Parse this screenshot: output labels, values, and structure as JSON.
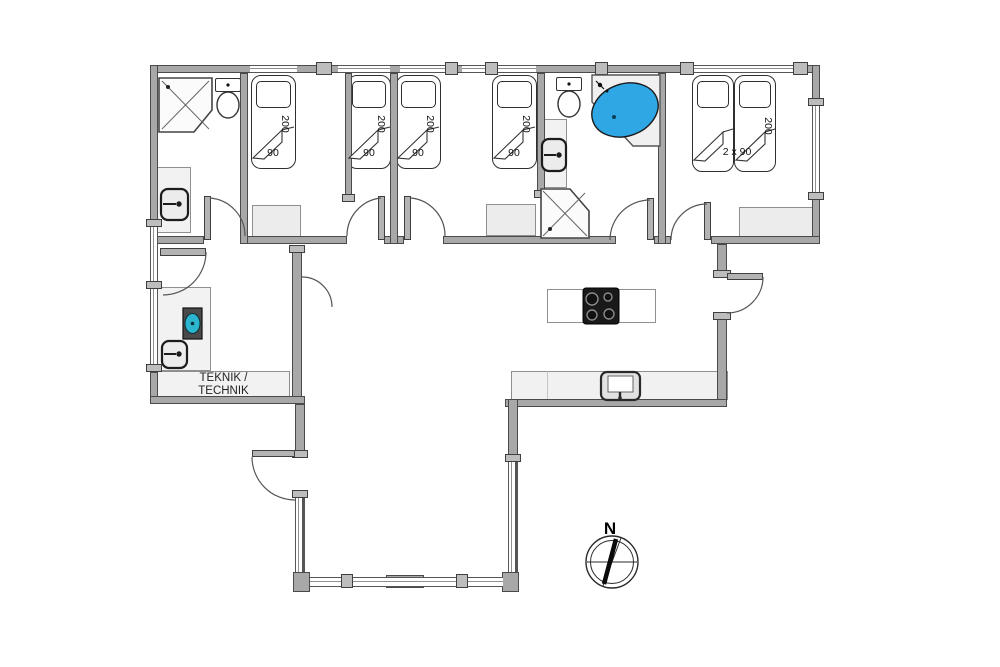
{
  "floorplan": {
    "bedrooms": {
      "bed1": {
        "length": "200",
        "width": "90"
      },
      "bed2": {
        "length": "200",
        "width": "90"
      },
      "bed3": {
        "length": "200",
        "width": "90"
      },
      "bed4": {
        "length": "200",
        "width": "90"
      },
      "double_bed": {
        "length": "200",
        "width": "2 x 90"
      }
    },
    "technical_room": {
      "label_line1": "TEKNIK /",
      "label_line2": "TECHNIK"
    },
    "compass": {
      "north": "N"
    },
    "colors": {
      "wall": "#a8a8a8",
      "wall-outline": "#4a4a4a",
      "tub-water": "#2fa7e4",
      "washer-accent": "#2cb5cf",
      "fixture-fill": "#f2f2f2"
    }
  }
}
